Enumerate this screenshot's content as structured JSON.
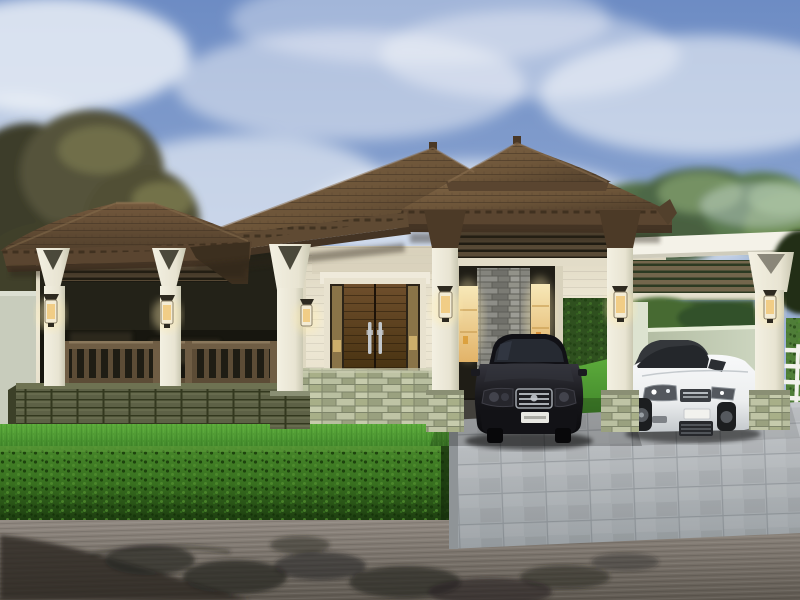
{
  "scene": {
    "title": "Modern bungalow house exterior rendering",
    "description": "3D architectural rendering of a single-storey contemporary house with brown tiled hip roofs and twin pyramid peaks, a covered veranda with white columns and wood railing, stacked-stone accent walls, a recessed entry with warm lit windows, a carport sheltering a black sedan, a flat-roof louvered pergola sheltering a white coupe, manicured lawn, trimmed front hedge, gray paver driveway and an asphalt street with tree shadows",
    "elements": {
      "sky": "blue sky with soft white clouds",
      "trees_left": "olive-brown foliage behind left perimeter wall",
      "trees_right": "gray-green treetops behind right pergola",
      "roof": "brown concrete-tile hip roof, two pyramid peaks with finials",
      "porch": "left veranda with louvered transom, wood balustrade, stone skirt wall",
      "entry": "recessed entrance flanked by glowing amber windows and gray stone pillar",
      "feature_window": "wood double panel with steel pull handles over green stacked-stone wall",
      "pergola": "white flat slab carport with horizontal wood louvers",
      "fence": "white horizontal-rail fence at far right over hedge",
      "lanterns": "warm wall lanterns mounted on every column",
      "vehicles": [
        {
          "type": "sedan",
          "color_name": "black",
          "position": "main carport",
          "details": "chrome grille, white license plate"
        },
        {
          "type": "coupe",
          "color_name": "white",
          "position": "right pergola bay",
          "details": "dark roof, mesh grille, white plate"
        }
      ],
      "landscape": "bright lawn strip, boxwood hedge, paver driveway, street with foliage shadows"
    }
  },
  "palette": {
    "skyTop": "#6d8cc4",
    "skyMid": "#8fa8d2",
    "skyLow": "#c6d0e4",
    "cloud": "#f3f6fa",
    "treeOlive": "#55533a",
    "treeOliveDark": "#3d3e29",
    "treeGreen": "#53704a",
    "treeGreenLight": "#8fae78",
    "roof": "#6d5539",
    "roofLight": "#7d6344",
    "roofDark": "#52402c",
    "fascia": "#5a4530",
    "soffit": "#443424",
    "wallCream": "#efe9d6",
    "wallShade": "#d8d1bb",
    "column": "#f3f0e2",
    "columnShade": "#c9c7b1",
    "capitalDark": "#4c3a27",
    "louver": "#584a36",
    "louverGap": "#1f1c12",
    "doorWood": "#5e4326",
    "doorDark": "#2c2418",
    "railWood": "#6f5d44",
    "stoneVeneer": "#aab189",
    "stoneGray": "#82827c",
    "baseStone": "#565a40",
    "windowGlow": "#f7e8b8",
    "windowGlowDeep": "#e2b368",
    "greenWall": "#ccd5bf",
    "perimeterWall": "#c8ccbc",
    "grass": "#4f9e33",
    "grassDark": "#3a7d26",
    "hedge": "#38701f",
    "hedgeDark": "#1d3d10",
    "pave": "#b8bcbf",
    "paveDark": "#9aa0a4",
    "road": "#857d75",
    "roadDark": "#5f5951",
    "shadow": "#2a2723",
    "carBlack": "#17171b",
    "carWhite": "#eceeef",
    "chrome": "#c2c7cc",
    "lanternGlow": "#ffedb0",
    "fenceWhite": "#f2f2ec"
  }
}
